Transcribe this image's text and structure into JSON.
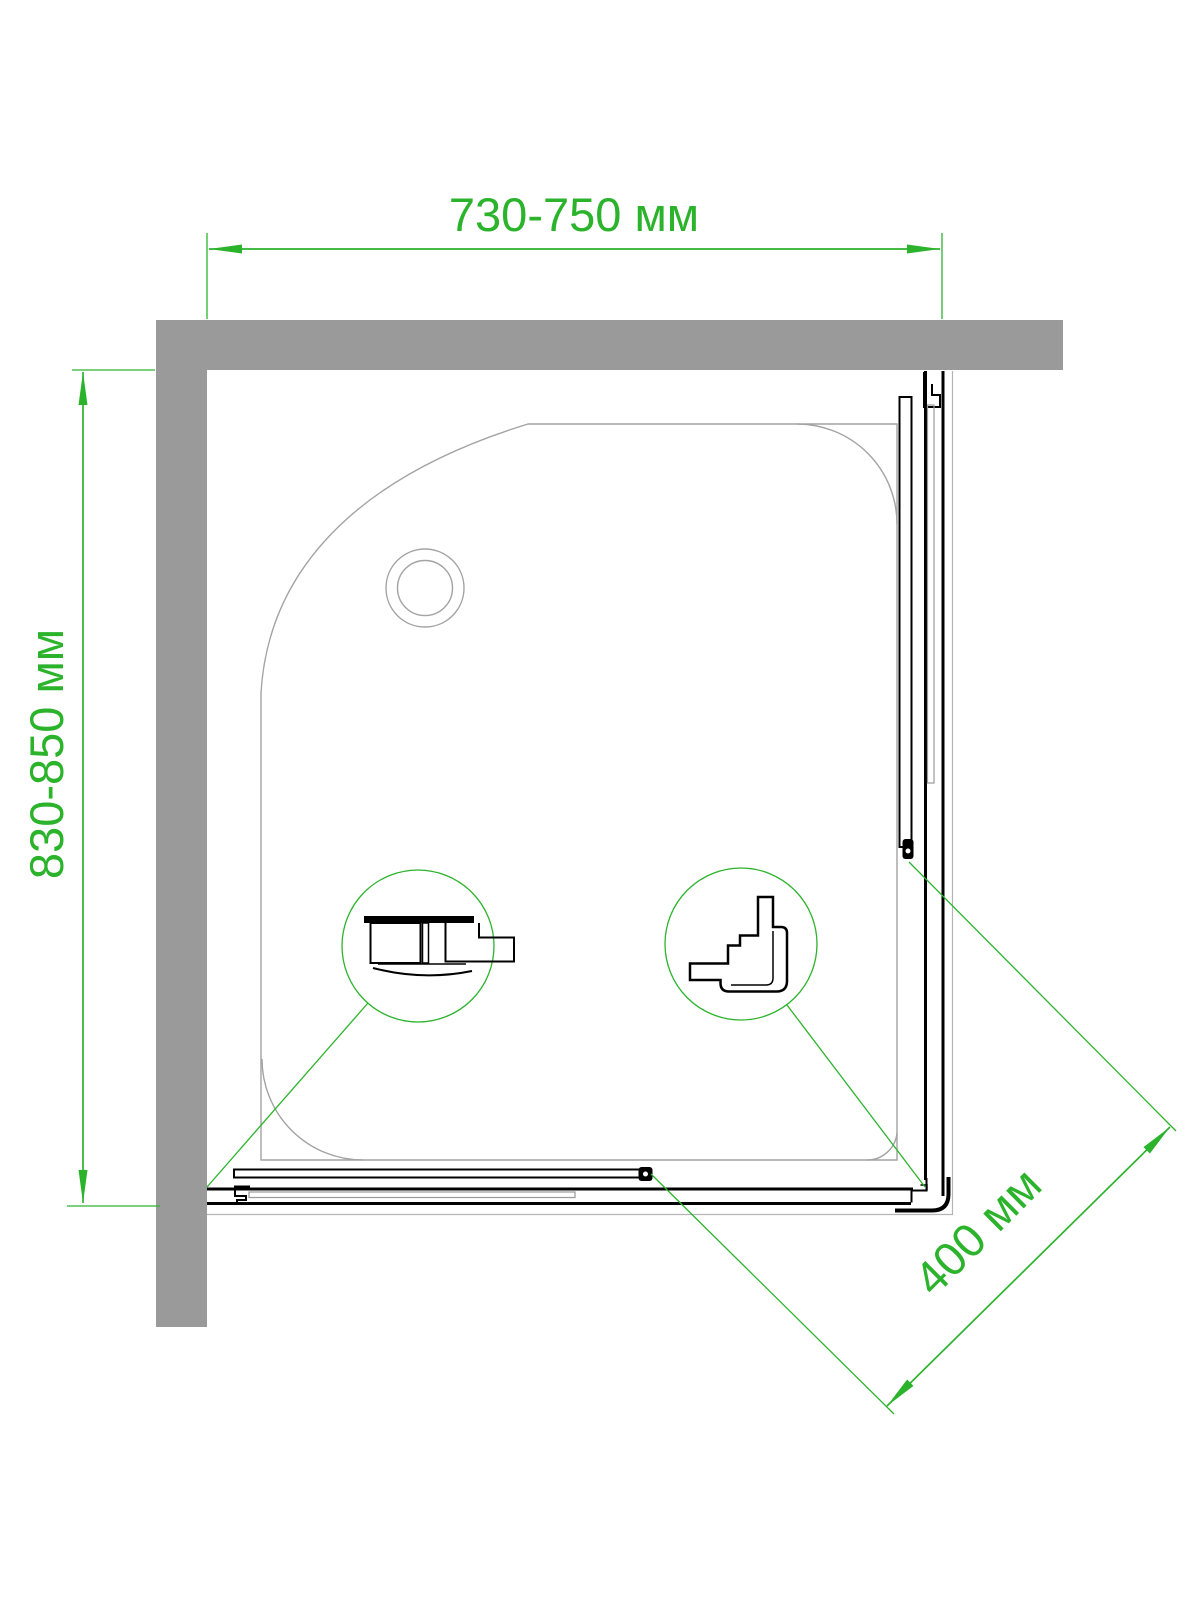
{
  "page": {
    "width": 1200,
    "height": 1600,
    "background": "#ffffff"
  },
  "drawing": {
    "subject": "corner shower enclosure — top view installation plan",
    "labels": {
      "width": "730-750 мм",
      "depth": "830-850 мм",
      "entry": "400 мм"
    },
    "colors": {
      "dimension_green": "#2cb32c",
      "wall_gray": "#9a9a9a",
      "profile_black": "#000000",
      "tray_outline_gray": "#a3a3a3"
    }
  }
}
